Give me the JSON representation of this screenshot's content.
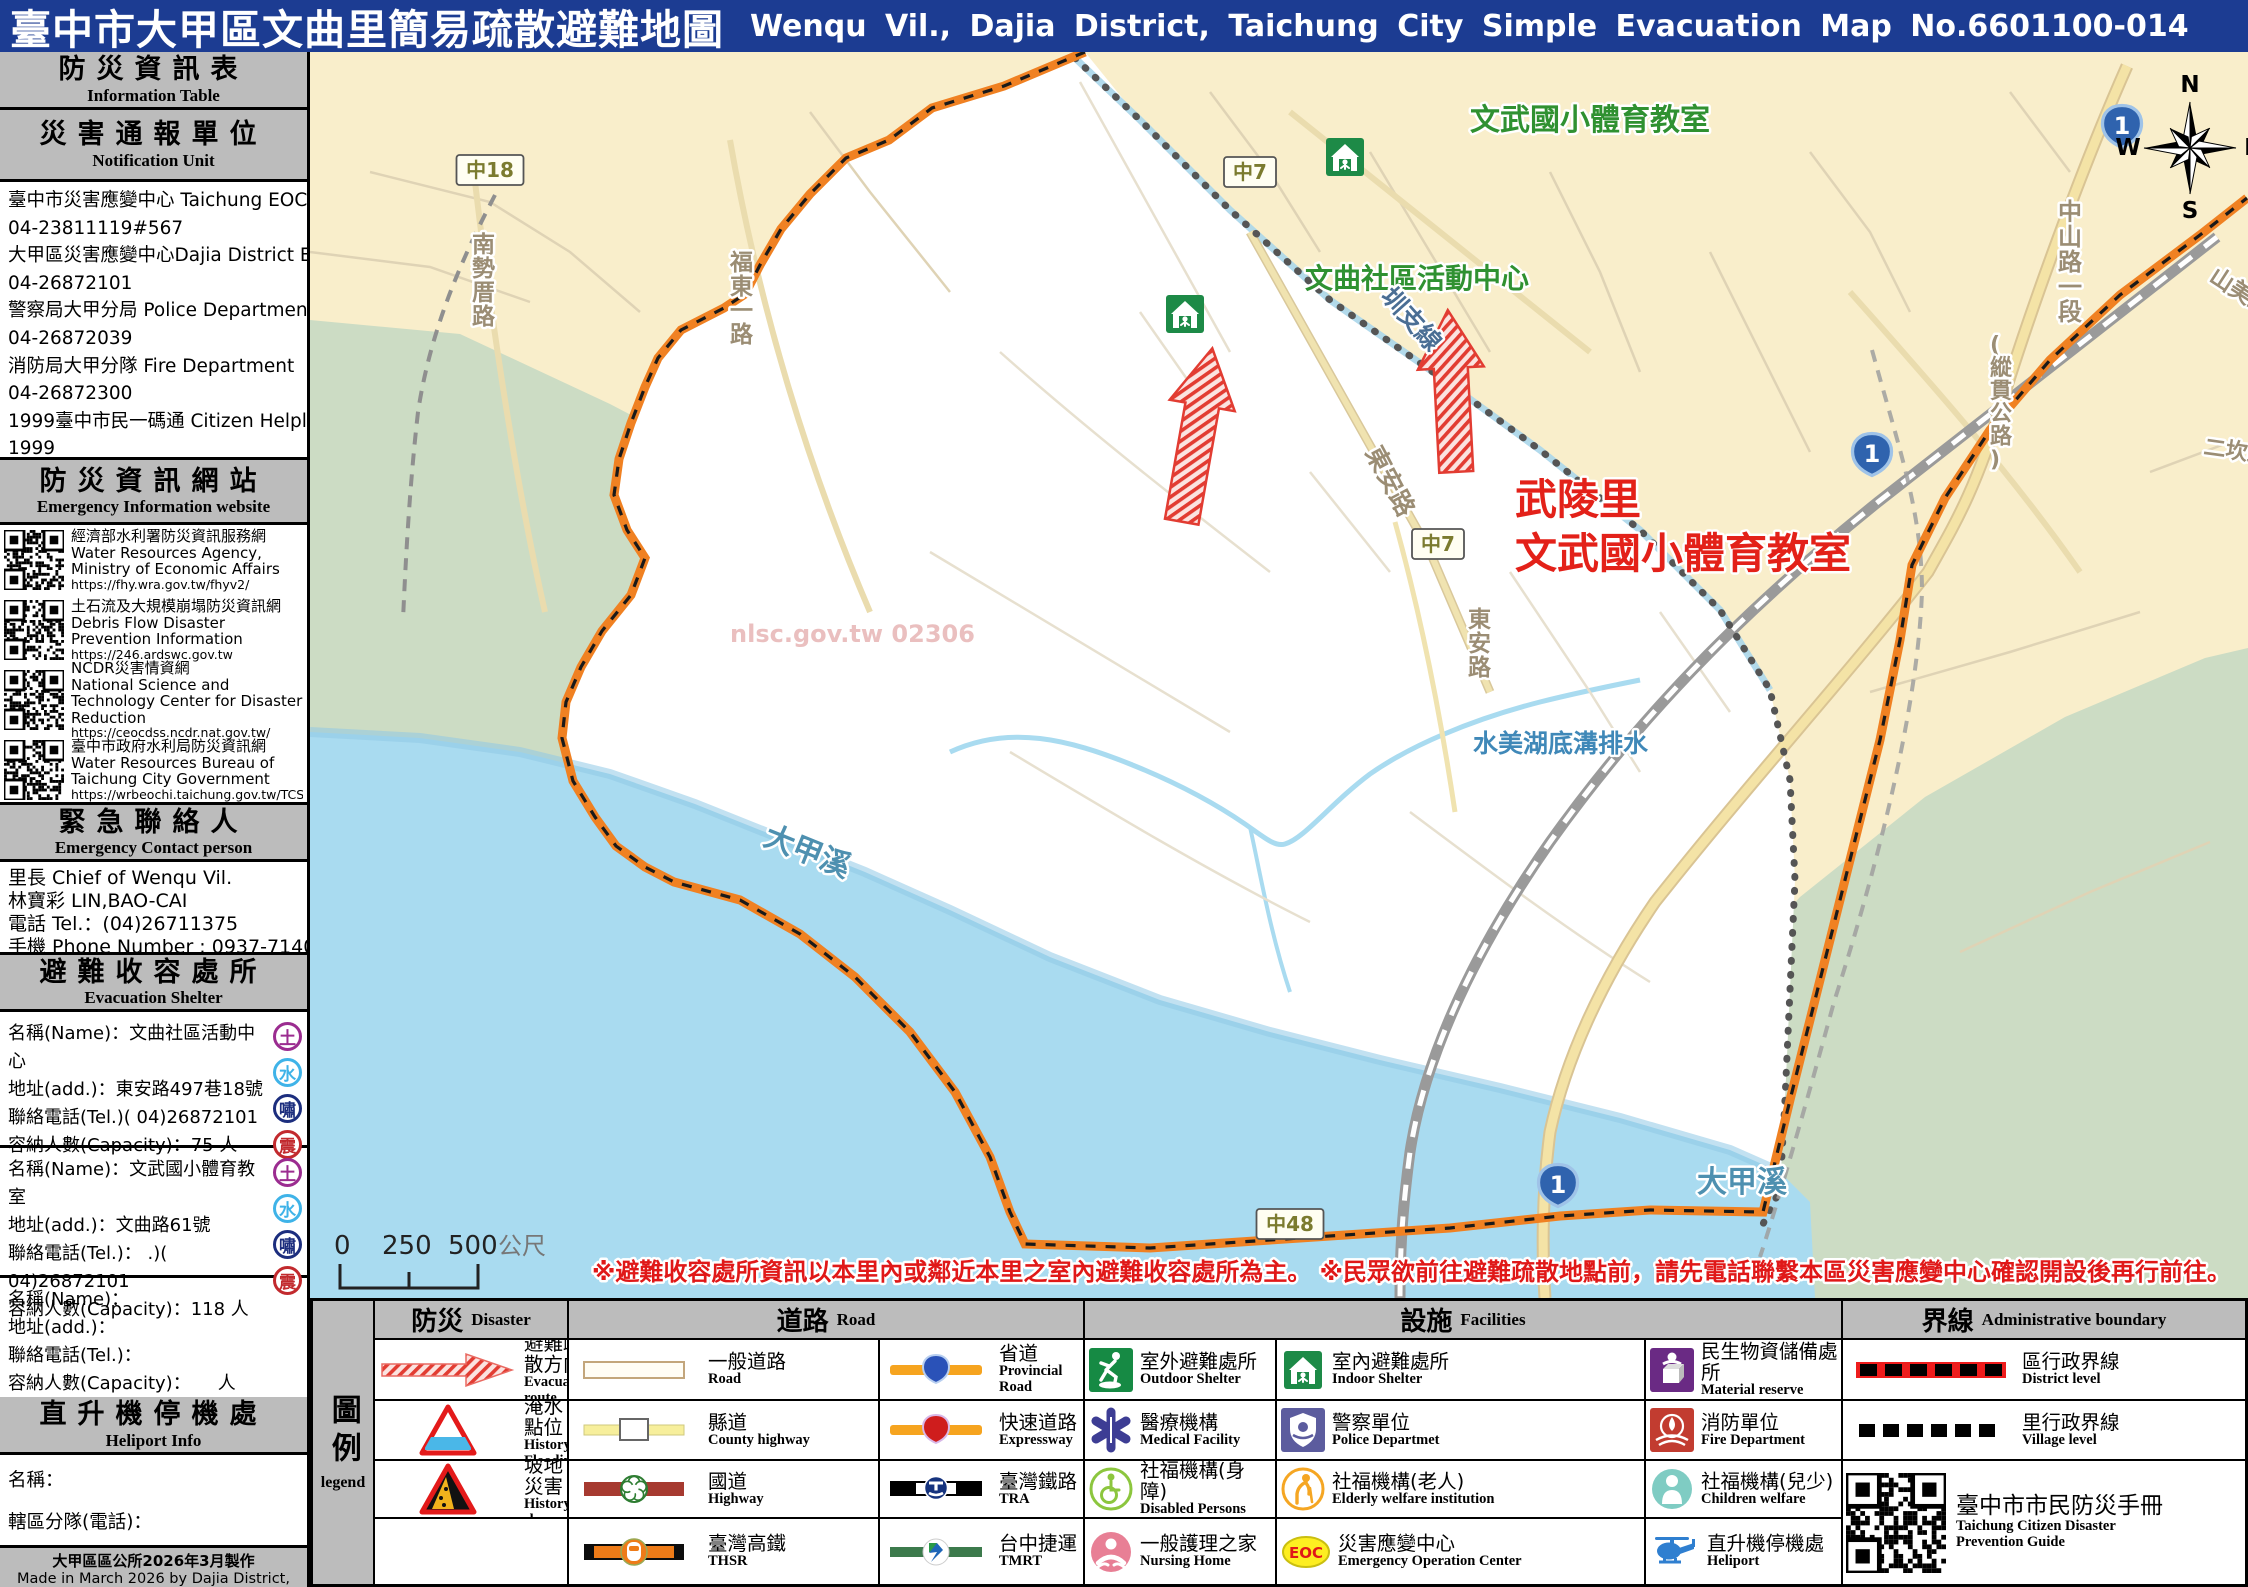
{
  "title": {
    "zh": "臺中市大甲區文曲里簡易疏散避難地圖",
    "en": "Wenqu Vil., Dajia District, Taichung City Simple Evacuation Map No.6601100-014"
  },
  "colors": {
    "titlebar": "#1c3c92",
    "panel_gray": "#bcbcbc",
    "boundary_orange": "#f08122",
    "poi_green": "#2f9131",
    "poi_red": "#e32119",
    "water": "#a9dbf0",
    "land": "#f9eecb",
    "floodplain": "#ccdcc4"
  },
  "sidebar": {
    "info_table": {
      "zh": "防災資訊表",
      "en": "Information  Table"
    },
    "notification_unit": {
      "zh": "災害通報單位",
      "en": "Notification  Unit"
    },
    "notification_lines": [
      "臺中市災害應變中心 Taichung EOC",
      "04-23811119#567",
      "大甲區災害應變中心Dajia District EOC",
      "04-26872101",
      "警察局大甲分局 Police Department",
      "04-26872039",
      "消防局大甲分隊 Fire Department",
      "04-26872300",
      "1999臺中市民一碼通 Citizen Helpline",
      "1999"
    ],
    "website_header": {
      "zh": "防災資訊網站",
      "en": "Emergency Information  website"
    },
    "websites": [
      {
        "zh": "經濟部水利署防災資訊服務網",
        "en": "Water Resources Agency, Ministry of Economic Affairs",
        "url": "https://fhy.wra.gov.tw/fhyv2/"
      },
      {
        "zh": "土石流及大規模崩塌防災資訊網",
        "en": "Debris Flow Disaster Prevention Information",
        "url": "https://246.ardswc.gov.tw"
      },
      {
        "zh": "NCDR災害情資網",
        "en": "National Science and Technology Center for Disaster Reduction",
        "url": "https://ceocdss.ncdr.nat.gov.tw/"
      },
      {
        "zh": "臺中市政府水利局防災資訊網",
        "en": "Water Resources Bureau of Taichung City Government",
        "url": "https://wrbeochi.taichung.gov.tw/TCSAFEp/"
      }
    ],
    "contact_header": {
      "zh": "緊急聯絡人",
      "en": "Emergency Contact person"
    },
    "contact_lines": [
      "里長 Chief of Wenqu Vil.",
      "林寶彩 LIN,BAO-CAI",
      "電話 Tel.：(04)26711375",
      "手機 Phone Number : 0937-714009"
    ],
    "shelter_header": {
      "zh": "避難收容處所",
      "en": "Evacuation  Shelter"
    },
    "hazard_badges": [
      {
        "char": "土",
        "color": "#9b2c90"
      },
      {
        "char": "水",
        "color": "#3fb3e8"
      },
      {
        "char": "嘯",
        "color": "#1c2e7e"
      },
      {
        "char": "震",
        "color": "#c22a2e"
      }
    ],
    "shelters": [
      {
        "lines": [
          "名稱(Name)：文曲社區活動中心",
          "地址(add.)：東安路497巷18號",
          "聯絡電話(Tel.)( 04)26872101",
          "容納人數(Capacity)：75 人"
        ],
        "badges": true
      },
      {
        "lines": [
          "名稱(Name)：文武國小體育教室",
          "地址(add.)：文曲路61號",
          "聯絡電話(Tel.)： .)( 04)26872101",
          "容納人數(Capacity)：118 人"
        ],
        "badges": true
      },
      {
        "lines": [
          "名稱(Name)：",
          "地址(add.)：",
          "聯絡電話(Tel.)：",
          "容納人數(Capacity)：　　人"
        ],
        "badges": false
      }
    ],
    "heliport_header": {
      "zh": "直升機停機處",
      "en": "Heliport  Info"
    },
    "heliport_lines": [
      "名稱：",
      "轄區分隊(電話)："
    ],
    "footer": {
      "zh": "大甲區區公所2026年3月製作",
      "en": "Made in March 2026 by Dajia District, Taichung City"
    }
  },
  "map": {
    "compass": {
      "n": "N",
      "e": "E",
      "s": "S",
      "w": "W"
    },
    "watermark": "nlsc.gov.tw 02306",
    "scale": {
      "t0": "0",
      "t1": "250",
      "t2": "500",
      "unit": "公尺"
    },
    "warning": "※避難收容處所資訊以本里內或鄰近本里之室內避難收容處所為主。 ※民眾欲前往避難疏散地點前，請先電話聯繫本區災害應變中心確認開設後再行前往。",
    "labels": [
      {
        "text": "文武國小體育教室",
        "x": 1160,
        "y": 78,
        "cls": "poi-green",
        "size": 30
      },
      {
        "text": "文曲社區活動中心",
        "x": 995,
        "y": 236,
        "cls": "poi-green",
        "size": 28
      },
      {
        "text": "武陵里",
        "x": 1205,
        "y": 462,
        "cls": "poi-red",
        "size": 42
      },
      {
        "text": "文武國小體育教室",
        "x": 1205,
        "y": 516,
        "cls": "poi-red",
        "size": 42
      },
      {
        "text": "東安路",
        "x": 1055,
        "y": 400,
        "cls": "road-name",
        "size": 25,
        "rot": 62
      },
      {
        "text": "東安路",
        "x": 1158,
        "y": 575,
        "cls": "road-name",
        "size": 23,
        "vertical": true
      },
      {
        "text": "圳支線",
        "x": 1070,
        "y": 245,
        "cls": "canal",
        "size": 25,
        "rot": 48
      },
      {
        "text": "水美湖底溝排水",
        "x": 1163,
        "y": 700,
        "cls": "stream",
        "size": 25
      },
      {
        "text": "大甲溪",
        "x": 452,
        "y": 792,
        "cls": "river",
        "size": 30,
        "rot": 22
      },
      {
        "text": "大甲溪",
        "x": 1387,
        "y": 1140,
        "cls": "river",
        "size": 30
      },
      {
        "text": "南勢厝路",
        "x": 162,
        "y": 200,
        "cls": "road-name",
        "size": 23,
        "vertical": true
      },
      {
        "text": "福東一路",
        "x": 420,
        "y": 218,
        "cls": "road-name",
        "size": 23,
        "vertical": true
      },
      {
        "text": "中山路一段",
        "x": 1748,
        "y": 168,
        "cls": "road-name",
        "size": 24,
        "vertical": true
      },
      {
        "text": "(縱貫公路)",
        "x": 1680,
        "y": 300,
        "cls": "road-name",
        "size": 22,
        "vertical": true
      },
      {
        "text": "山美路",
        "x": 1898,
        "y": 228,
        "cls": "road-name",
        "size": 23,
        "rot": 33
      },
      {
        "text": "二坎路",
        "x": 1893,
        "y": 402,
        "cls": "road-name",
        "size": 22,
        "rot": 8
      }
    ],
    "markers": [
      {
        "kind": "county",
        "text": "中18",
        "x": 180,
        "y": 118
      },
      {
        "kind": "county",
        "text": "中7",
        "x": 940,
        "y": 120
      },
      {
        "kind": "county",
        "text": "中7",
        "x": 1128,
        "y": 492
      },
      {
        "kind": "county",
        "text": "中48",
        "x": 980,
        "y": 1172
      },
      {
        "kind": "provincial",
        "text": "1",
        "x": 1812,
        "y": 73
      },
      {
        "kind": "provincial",
        "text": "1",
        "x": 1562,
        "y": 401
      },
      {
        "kind": "provincial",
        "text": "1",
        "x": 1248,
        "y": 1132
      }
    ],
    "shelter_icons": [
      {
        "x": 1016,
        "y": 86
      },
      {
        "x": 856,
        "y": 243
      }
    ],
    "arrows": [
      {
        "cx": 887,
        "top": 295,
        "len": 176,
        "rot": 10
      },
      {
        "cx": 1142,
        "top": 258,
        "len": 162,
        "rot": -3
      }
    ]
  },
  "legend": {
    "corner": {
      "zh": "圖例",
      "en": "legend"
    },
    "headers": {
      "disaster": {
        "zh": "防災",
        "en": "Disaster"
      },
      "road": {
        "zh": "道路",
        "en": "Road"
      },
      "facilities": {
        "zh": "設施",
        "en": "Facilities"
      },
      "boundary": {
        "zh": "界線",
        "en": "Administrative  boundary"
      }
    },
    "disaster": [
      {
        "zh": "避難疏散方向",
        "en": "Evacuation  route"
      },
      {
        "zh": "歷史淹水點位",
        "en": "History Flooding Point"
      },
      {
        "zh": "歷史坡地災害",
        "en": "History slope point"
      }
    ],
    "road_a": [
      {
        "zh": "一般道路",
        "en": "Road"
      },
      {
        "zh": "縣道",
        "en": "County  highway"
      },
      {
        "zh": "國道",
        "en": "Highway"
      },
      {
        "zh": "臺灣高鐵",
        "en": "THSR"
      }
    ],
    "road_b": [
      {
        "zh": "省道",
        "en": "Provincial  Road"
      },
      {
        "zh": "快速道路",
        "en": "Expressway"
      },
      {
        "zh": "臺灣鐵路",
        "en": "TRA"
      },
      {
        "zh": "台中捷運",
        "en": "TMRT"
      }
    ],
    "fac_a": [
      {
        "zh": "室外避難處所",
        "en": "Outdoor  Shelter"
      },
      {
        "zh": "醫療機構",
        "en": "Medical  Facility"
      },
      {
        "zh": "社福機構(身障)",
        "en": "Disabled  Persons"
      },
      {
        "zh": "一般護理之家",
        "en": "Nursing Home"
      }
    ],
    "fac_b": [
      {
        "zh": "室內避難處所",
        "en": "Indoor  Shelter"
      },
      {
        "zh": "警察單位",
        "en": "Police Departmet"
      },
      {
        "zh": "社福機構(老人)",
        "en": "Elderly  welfare  institution"
      },
      {
        "zh": "災害應變中心",
        "en": "Emergency  Operation  Center"
      }
    ],
    "fac_c": [
      {
        "zh": "民生物資儲備處所",
        "en": "Material  reserve"
      },
      {
        "zh": "消防單位",
        "en": "Fire Department"
      },
      {
        "zh": "社福機構(兒少)",
        "en": "Children welfare"
      },
      {
        "zh": "直升機停機處",
        "en": "Heliport"
      }
    ],
    "boundary": [
      {
        "zh": "區行政界線",
        "en": "District level"
      },
      {
        "zh": "里行政界線",
        "en": "Village level"
      }
    ],
    "qr_caption": {
      "zh": "臺中市市民防災手冊",
      "en1": "Taichung Citizen Disaster",
      "en2": "Prevention  Guide"
    }
  }
}
